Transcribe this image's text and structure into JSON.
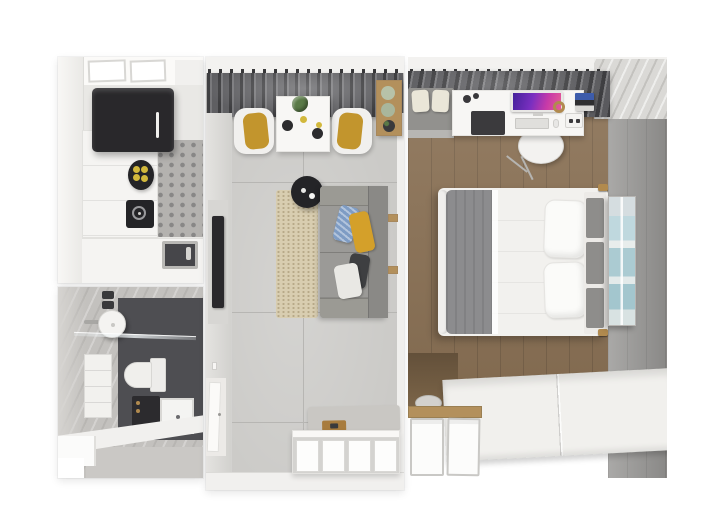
{
  "meta": {
    "description": "Top-down 3D rendered floor plan of a small apartment with kitchen, bathroom, living room and bedroom",
    "rooms": [
      "kitchen",
      "bathroom",
      "living-room",
      "bedroom"
    ]
  },
  "colors": {
    "bg": "#ffffff",
    "wall-white": "#f3f2f0",
    "concrete-wall": "#c3c1be",
    "living-floor": "#cbcac7",
    "floor-seam": "#b7b6b3",
    "bath-floor": "#4e4e52",
    "wood-floor": "#8a7155",
    "wood-shelf": "#b3905c",
    "curtain": "#69696c",
    "ring-dark": "#39393b",
    "fridge": "#29282b",
    "counter": "#f5f4f2",
    "tile-gray": "#b4b2af",
    "sink-dark": "#46464a",
    "appliance-dark": "#242427",
    "fruit-yellow": "#d2b83c",
    "fixture-white": "#f2f1ee",
    "washer-dark": "#2c2b2e",
    "brass": "#b18a4e",
    "table-white": "#f8f7f5",
    "chair-white": "#f1f0ee",
    "cushion-mustard": "#c2952d",
    "plant-green": "#5a7a47",
    "pot-sage": "#b7c2a8",
    "coffee-black": "#242427",
    "rug-beige": "#d8cdb0",
    "sofa-gray": "#8f8e8b",
    "sofa-seat": "#9b9a97",
    "pillow-blue": "#7e9cc4",
    "pillow-mustard": "#d4a02a",
    "pillow-dark": "#3e3f41",
    "pillow-white": "#e9e8e4",
    "tv-dark": "#2a292c",
    "sideboard": "#f9f8f6",
    "bench-gray": "#c9c7c3",
    "tray-wood": "#a87c3e",
    "gray-wall": "#9c9b99",
    "desk-white": "#f7f6f4",
    "imac-a": "#44219b",
    "imac-b": "#e85e96",
    "book-blue": "#3d5cab",
    "bench-cushion": "#eae6d8",
    "bed-blanket": "#8c8c8e",
    "bed-sheet": "#f2f1ee",
    "bed-pillow": "#fbfbf9",
    "headboard": "#eceae7",
    "headboard-cushion": "#8e8d8b",
    "art-a": "#d5dde0",
    "art-b": "#bfd8de",
    "art-c": "#abcbd2",
    "wardrobe": "#f1f0ed",
    "bin-white": "#fcfcfb",
    "bin-edge": "#c9c8c5"
  },
  "scene": {
    "kitchen": {
      "items": [
        "window",
        "refrigerator",
        "countertop",
        "fruit-bowl",
        "cooktop",
        "tiled-backsplash",
        "sink",
        "faucet"
      ]
    },
    "bathroom": {
      "items": [
        "washbasin",
        "faucet",
        "towels",
        "glass-shower-screen",
        "vanity-cabinet",
        "toilet",
        "washing-machine",
        "shower-tray",
        "partition-wall"
      ]
    },
    "living_room": {
      "items": [
        "curtains",
        "dining-table",
        "table-plant",
        "plates",
        "dining-chairs",
        "plant-shelf",
        "coffee-table",
        "rug",
        "sofa",
        "sofa-pillows",
        "ladder-shelf",
        "wall-tv",
        "light-switch",
        "door",
        "ottoman-bench",
        "serving-tray",
        "sideboard"
      ]
    },
    "bedroom": {
      "items": [
        "curtains",
        "bench-with-cushions",
        "desk",
        "desktop-computer",
        "keyboard",
        "mouse",
        "desk-pad",
        "headphones",
        "speaker",
        "books",
        "desk-chair",
        "double-bed",
        "blanket",
        "pillows",
        "headboard",
        "wall-art",
        "accent-wall",
        "laundry-basket",
        "wardrobe-top",
        "wood-shelf",
        "storage-bins"
      ]
    }
  }
}
